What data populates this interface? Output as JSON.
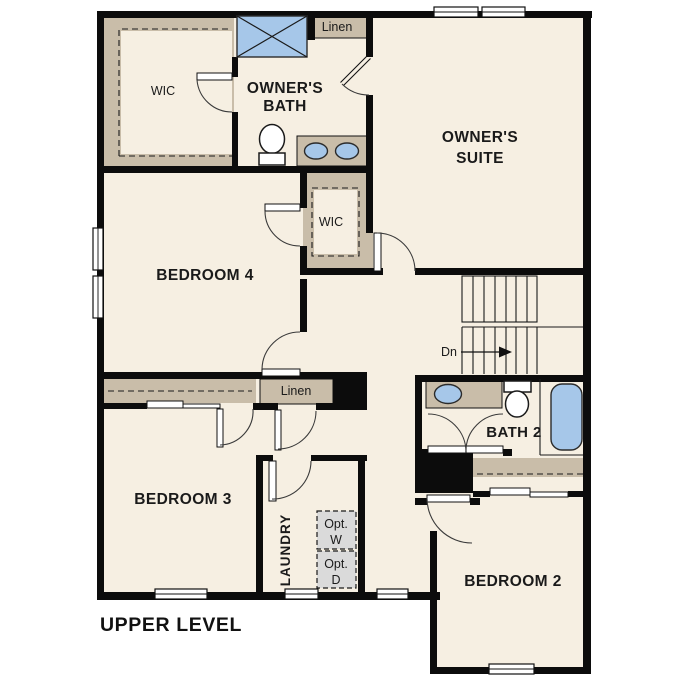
{
  "title": "UPPER LEVEL",
  "colors": {
    "floor": "#f6efe2",
    "closet_tan": "#c9bda9",
    "fixture_blue": "#a6c7e9",
    "appliance_gray": "#dadada",
    "wall": "#0c0c0c"
  },
  "rooms": {
    "owners_suite": {
      "label_line1": "OWNER'S",
      "label_line2": "SUITE"
    },
    "owners_bath": {
      "label_line1": "OWNER'S",
      "label_line2": "BATH"
    },
    "owners_wic": {
      "label": "WIC"
    },
    "linen_upper": {
      "label": "Linen"
    },
    "bedroom4": {
      "label": "BEDROOM 4"
    },
    "wic2": {
      "label": "WIC"
    },
    "linen_hall": {
      "label": "Linen"
    },
    "bedroom3": {
      "label": "BEDROOM 3"
    },
    "laundry": {
      "label": "LAUNDRY",
      "washer_line1": "Opt.",
      "washer_line2": "W",
      "dryer_line1": "Opt.",
      "dryer_line2": "D"
    },
    "bath2": {
      "label": "BATH 2"
    },
    "bedroom2": {
      "label": "BEDROOM 2"
    }
  },
  "stairs": {
    "direction_label": "Dn"
  }
}
